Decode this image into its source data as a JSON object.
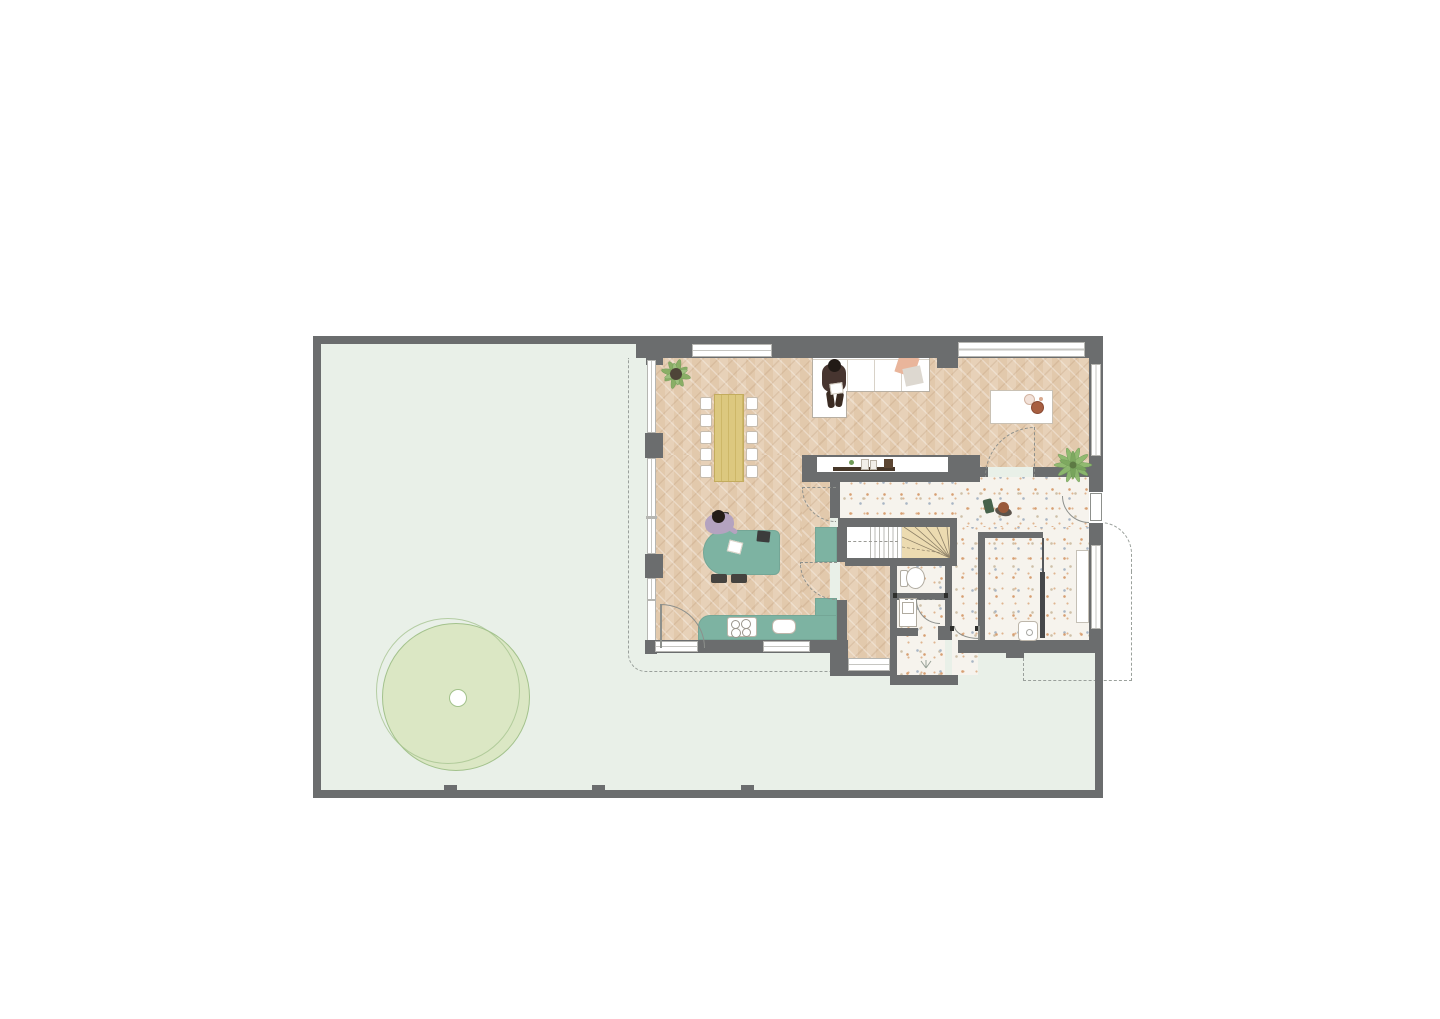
{
  "meta": {
    "title": "ground-floor-plan",
    "drawing_type": "residential floor plan, top view, no text labels"
  },
  "colors": {
    "wall": "#6b6d6e",
    "garden": "#e9f0e8",
    "herringbone": "#e7d1b8",
    "terrazzo": "#f6f3ed",
    "teal": "#7db3a2",
    "wood-table": "#d9c47c",
    "winder": "#ecdbb1",
    "tree-fill": "#d8e5bd",
    "tree-stroke": "#a3c28c",
    "dash": "#9aa09b",
    "cushion-pink": "#e9b59b",
    "cushion-gray": "#ddd8d0",
    "media-bar": "#473729",
    "plant-green": "#7ca55e"
  },
  "plan": {
    "site": {
      "boundary": "walled rectangular plot",
      "garden": "lawn wrapping left and bottom of house",
      "tree_count": 1,
      "boundary_piers": 3
    },
    "rooms": [
      {
        "id": "living-dining",
        "floor": "herringbone parquet"
      },
      {
        "id": "office-nook",
        "floor": "herringbone parquet"
      },
      {
        "id": "kitchen",
        "floor": "herringbone parquet"
      },
      {
        "id": "hallway",
        "floor": "terrazzo"
      },
      {
        "id": "stairwell",
        "floor": "white treads + timber winders"
      },
      {
        "id": "wc",
        "floor": "terrazzo"
      },
      {
        "id": "utility",
        "floor": "terrazzo"
      },
      {
        "id": "vestibule",
        "floor": "terrazzo"
      },
      {
        "id": "storage-shower",
        "floor": "terrazzo"
      }
    ],
    "furniture": [
      "l-shaped-sofa",
      "ottoman",
      "dining-table",
      "dining-chairs x10",
      "island-desk",
      "desk-chairs x3",
      "kitchen-counter-L",
      "cooktop",
      "sink",
      "tv-media-console",
      "office-table",
      "toilet",
      "washer",
      "shower-tray",
      "wardrobe-niche",
      "window-sill-niche"
    ],
    "plants": [
      "potted-plant-living",
      "palm-plant-office",
      "garden-tree",
      "vestibule-sprout"
    ],
    "people": [
      "person-reading-on-sofa",
      "person-working-at-desk",
      "person-walking-in-hallway"
    ],
    "doors": [
      "front-door-right-wall",
      "garden-door-kitchen",
      "vestibule-door",
      "utility-door",
      "office-dashed-door",
      "hall-dashed-opening x2"
    ],
    "dashed_outlines": [
      "upper-floor-overhang-left",
      "entry-canopy-right"
    ]
  }
}
